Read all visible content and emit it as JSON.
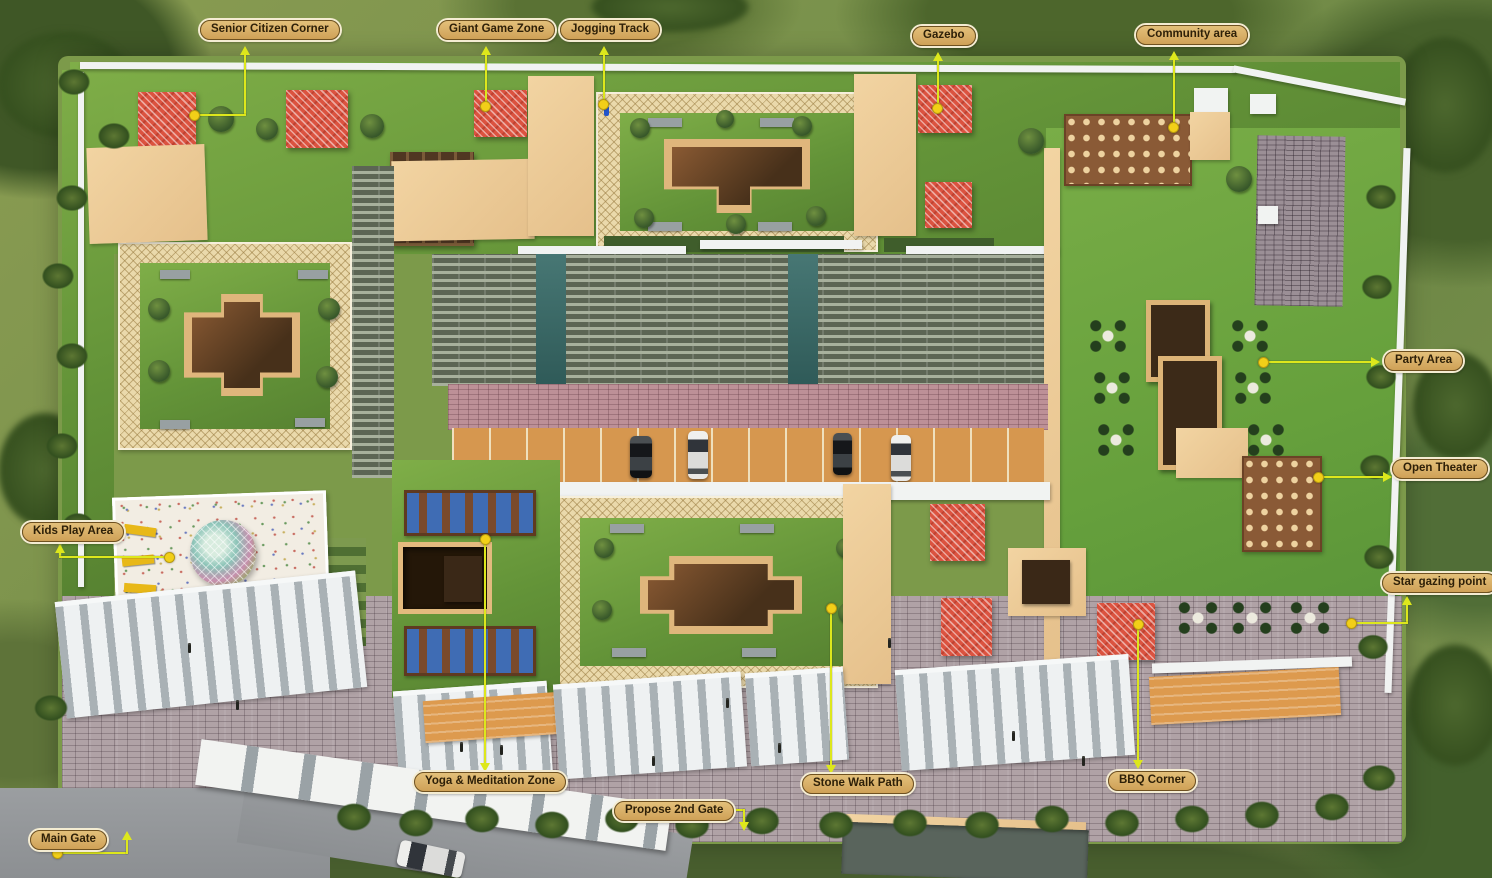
{
  "title": "Residential complex aerial site plan with amenity callouts",
  "labels": [
    {
      "id": "senior-citizen-corner",
      "text": "Senior Citizen Corner"
    },
    {
      "id": "giant-game-zone",
      "text": "Giant Game Zone"
    },
    {
      "id": "jogging-track",
      "text": "Jogging Track"
    },
    {
      "id": "gazebo",
      "text": "Gazebo"
    },
    {
      "id": "community-area",
      "text": "Community area"
    },
    {
      "id": "party-area",
      "text": "Party Area"
    },
    {
      "id": "open-theater",
      "text": "Open Theater"
    },
    {
      "id": "star-gazing-point",
      "text": "Star gazing point"
    },
    {
      "id": "kids-play-area",
      "text": "Kids Play Area"
    },
    {
      "id": "yoga-meditation-zone",
      "text": "Yoga & Meditation Zone"
    },
    {
      "id": "stone-walk-path",
      "text": "Stone Walk Path"
    },
    {
      "id": "propose-2nd-gate",
      "text": "Propose 2nd Gate"
    },
    {
      "id": "bbq-corner",
      "text": "BBQ Corner"
    },
    {
      "id": "main-gate",
      "text": "Main Gate"
    }
  ],
  "style": {
    "label_background": "#d9b264",
    "label_border": "#6f5120",
    "label_text": "#2e2008",
    "leader_line": "#dde71c",
    "leader_dot": "#f2cf18",
    "grass_green": "#6e9a3e",
    "pavilion_roof_red": "#db5340",
    "building_roof_beige": "#ecc894",
    "plaza_brick": "#b0a2a6",
    "lattice_path": "#ead9ab"
  }
}
